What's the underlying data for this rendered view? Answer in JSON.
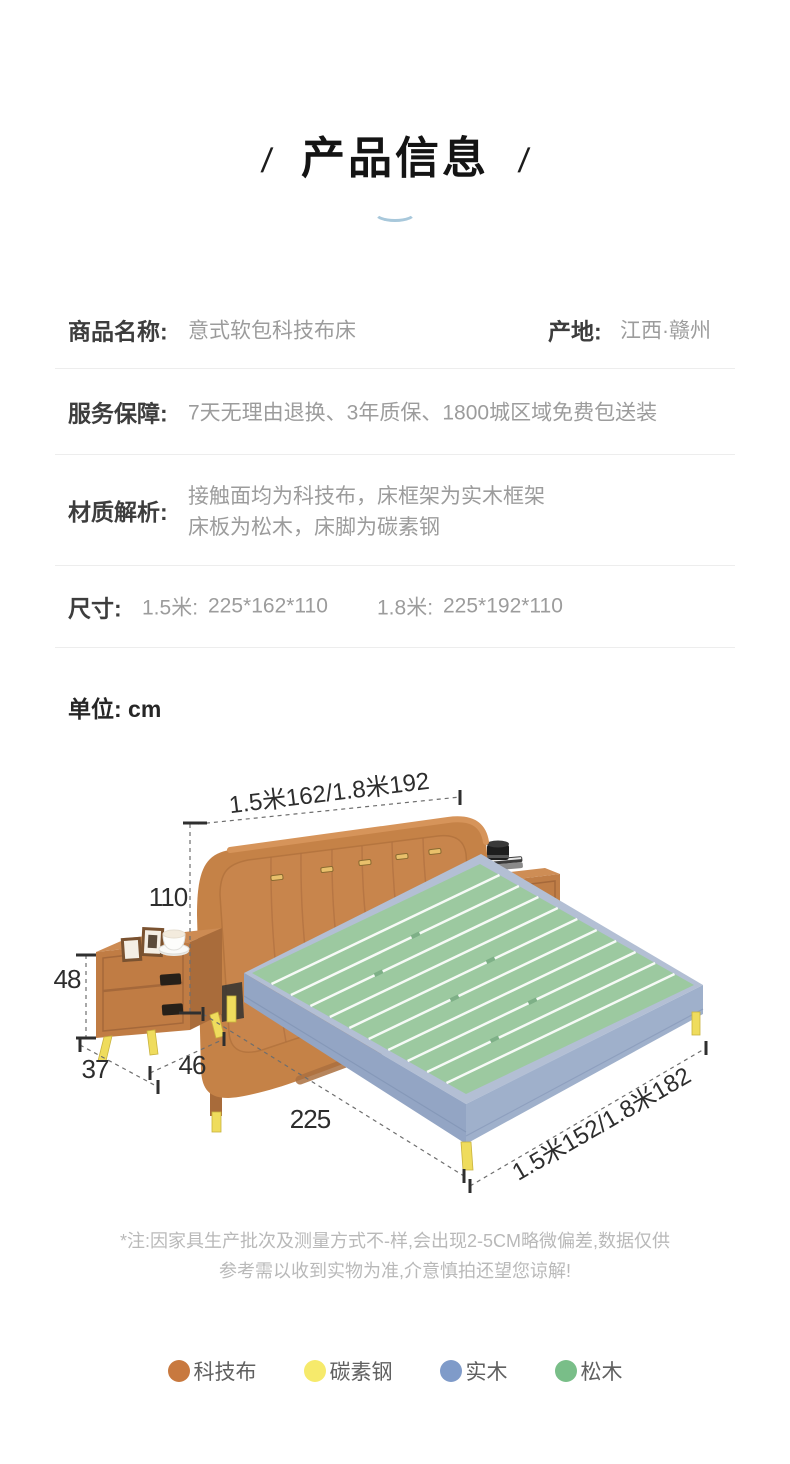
{
  "header": {
    "title": "产品信息",
    "slash": "/"
  },
  "info_table": {
    "row1": {
      "label": "商品名称:",
      "value": "意式软包科技布床",
      "origin_label": "产地:",
      "origin_value": "江西·赣州"
    },
    "row2": {
      "label": "服务保障:",
      "value": "7天无理由退换、3年质保、1800城区域免费包送装"
    },
    "row3": {
      "label": "材质解析:",
      "value_line1": "接触面均为科技布，床框架为实木框架",
      "value_line2": "床板为松木，床脚为碳素钢"
    },
    "row4": {
      "label": "尺寸:",
      "size1_label": "1.5米:",
      "size1_value": "225*162*110",
      "size2_label": "1.8米:",
      "size2_value": "225*192*110"
    }
  },
  "unit_note": "单位: cm",
  "diagram": {
    "dim_top_width": "1.5米162/1.8米192",
    "dim_bed_height": "110",
    "dim_nightstand_height": "48",
    "dim_nightstand_depth": "37",
    "dim_nightstand_width": "46",
    "dim_bed_length": "225",
    "dim_bottom_width": "1.5米152/1.8米182"
  },
  "disclaimer": {
    "line1": "*注:因家具生产批次及测量方式不-样,会出现2-5CM略微偏差,数据仅供",
    "line2": "参考需以收到实物为准,介意慎拍还望您谅解!"
  },
  "legend": {
    "items": [
      {
        "label": "科技布",
        "color": "#C8793F"
      },
      {
        "label": "碳素钢",
        "color": "#F6EA6B"
      },
      {
        "label": "实木",
        "color": "#7F9BC9"
      },
      {
        "label": "松木",
        "color": "#79BE88"
      }
    ]
  },
  "colors": {
    "accent_arc": "#A8C8DB",
    "fabric": "#C58247",
    "steel": "#EFDC5D",
    "wood_frame": "#93A5C4",
    "pine_slats": "#9CC9A0"
  }
}
